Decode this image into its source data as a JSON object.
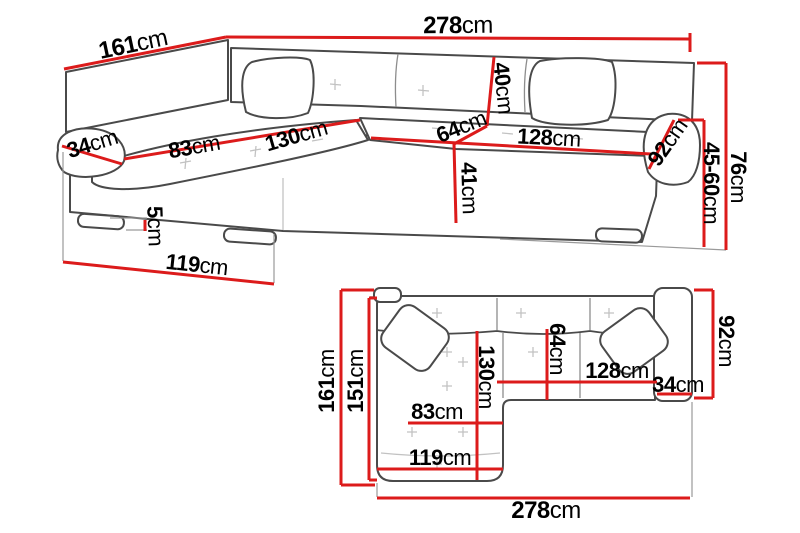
{
  "figure": {
    "kind": "furniture dimension diagram",
    "subject": "corner sofa with chaise, perspective view and top plan view",
    "unit": "cm"
  },
  "colors": {
    "dimension_red": "#dc1b1b",
    "outline_gray": "#4a4a4a",
    "detail_gray": "#c2c2c2"
  },
  "perspective_view": {
    "dims": {
      "total_width": {
        "value": "278",
        "unit": "cm"
      },
      "left_side_depth": {
        "value": "161",
        "unit": "cm"
      },
      "left_armrest_width": {
        "value": "34",
        "unit": "cm"
      },
      "chaise_cushion_width": {
        "value": "83",
        "unit": "cm"
      },
      "chaise_cushion_length": {
        "value": "130",
        "unit": "cm"
      },
      "backrest_height": {
        "value": "40",
        "unit": "cm"
      },
      "seat_depth": {
        "value": "64",
        "unit": "cm"
      },
      "seat_width": {
        "value": "128",
        "unit": "cm"
      },
      "right_armrest_length": {
        "value": "92",
        "unit": "cm"
      },
      "front_height": {
        "value": "41",
        "unit": "cm"
      },
      "seat_height_range": {
        "value": "45-60",
        "unit": "cm"
      },
      "total_height": {
        "value": "76",
        "unit": "cm"
      },
      "leg_height": {
        "value": "5",
        "unit": "cm"
      },
      "chaise_outer_length": {
        "value": "119",
        "unit": "cm"
      }
    }
  },
  "plan_view": {
    "dims": {
      "total_depth": {
        "value": "161",
        "unit": "cm"
      },
      "inner_depth": {
        "value": "151",
        "unit": "cm"
      },
      "chaise_length": {
        "value": "130",
        "unit": "cm"
      },
      "seat_depth": {
        "value": "64",
        "unit": "cm"
      },
      "seat_width": {
        "value": "128",
        "unit": "cm"
      },
      "right_armrest_width": {
        "value": "34",
        "unit": "cm"
      },
      "right_side_depth": {
        "value": "92",
        "unit": "cm"
      },
      "chaise_cushion_width": {
        "value": "83",
        "unit": "cm"
      },
      "chaise_outer_width": {
        "value": "119",
        "unit": "cm"
      },
      "total_width": {
        "value": "278",
        "unit": "cm"
      }
    }
  }
}
